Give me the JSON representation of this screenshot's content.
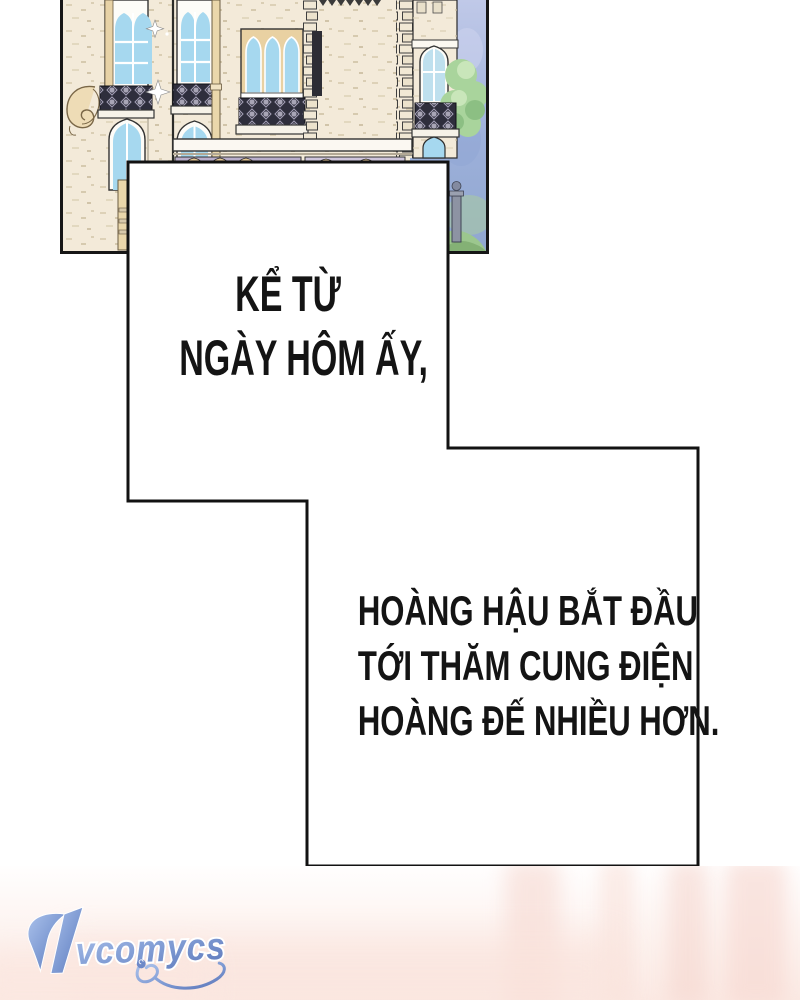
{
  "page": {
    "background": "#ffffff",
    "narration": {
      "ink": "#141414",
      "box_fill": "#ffffff",
      "box1": {
        "lines": [
          "KỂ TỪ",
          "NGÀY HÔM ẤY,"
        ]
      },
      "box2": {
        "lines": [
          "HOÀNG HẬU BẮT ĐẦU",
          "TỚI THĂM CUNG ĐIỆN",
          "HOÀNG ĐẾ NHIỀU HƠN."
        ]
      }
    },
    "illustration": {
      "name": "castle-facade-illustration",
      "colors": {
        "stone": "#f3ead9",
        "trim": "#e9d1a2",
        "glass": "#a6d8ef",
        "railing": "#2e2e3c",
        "sky_top": "#c0c9e8",
        "sky_bottom": "#90a7d0",
        "tree": "#a9d49c",
        "hill": "#9cc78e",
        "outline": "#161616"
      }
    },
    "watermark": {
      "text": "VCOMYCS",
      "color": "#7d99d2"
    },
    "bottom_art": {
      "tint": "#fbe9e3"
    }
  }
}
